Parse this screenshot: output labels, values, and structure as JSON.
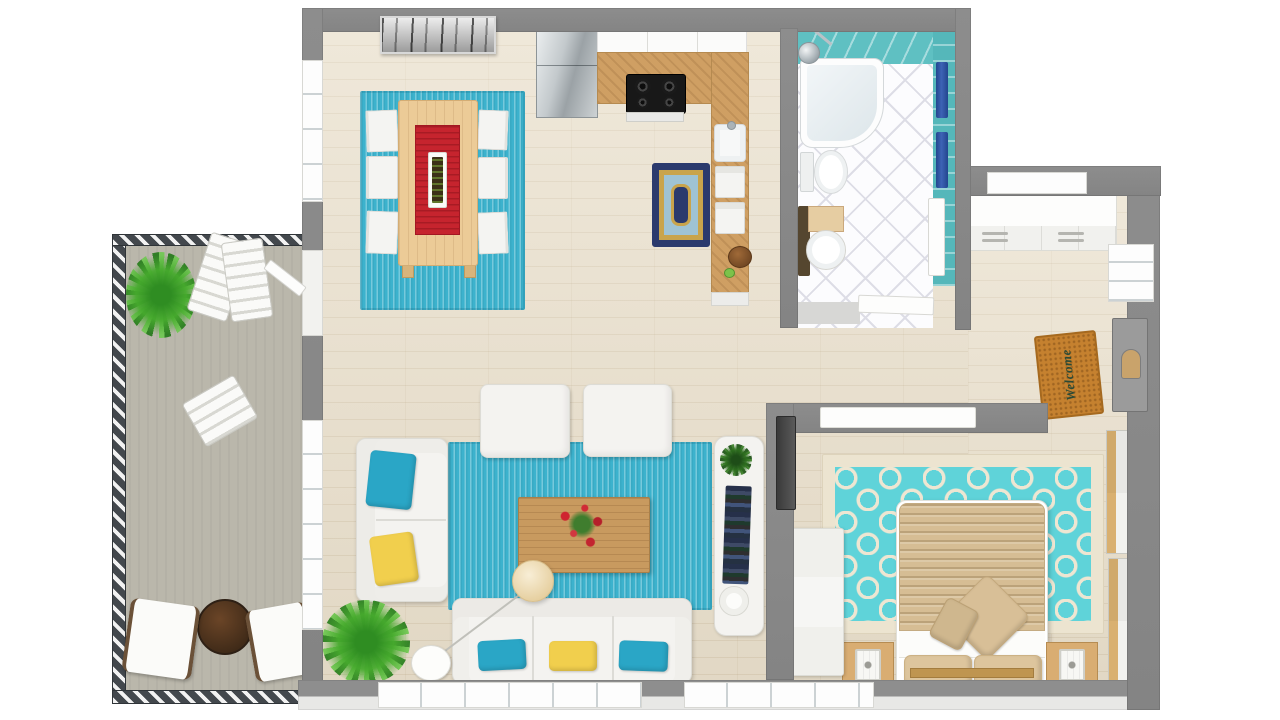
{
  "scene": {
    "type": "3D floor plan render",
    "description": "Top-down 3D floor plan of a one-bedroom apartment with balcony, turquoise accent decor",
    "welcome_mat_text": "Welcome"
  },
  "palette": {
    "wall_gray": "#8d8d8d",
    "wood_floor": "#e9dfcb",
    "balcony_floor": "#bab7ab",
    "rug_teal": "#3cb2cd",
    "bath_tile_teal": "#5fc0c2",
    "bedroom_rug_teal": "#5fd3d9",
    "bedroom_rug_cream": "#ece4d0",
    "runner_red": "#c6242e",
    "accent_yellow": "#f1cf4d",
    "towel_navy": "#3d63b5",
    "counter_wood": "#cf9f63",
    "table_wood": "#eccb97",
    "bed_tan": "#d6bd94",
    "mat_orange": "#c5812f",
    "plant_green": "#4aa832",
    "furniture_white": "#f4f3f0"
  },
  "rooms": [
    {
      "name": "balcony"
    },
    {
      "name": "dining-area"
    },
    {
      "name": "kitchen"
    },
    {
      "name": "bathroom"
    },
    {
      "name": "entry"
    },
    {
      "name": "hallway"
    },
    {
      "name": "living-room"
    },
    {
      "name": "bedroom"
    }
  ],
  "furniture": [
    "dining table with red runner",
    "six dining chairs",
    "dining rug",
    "wall art",
    "refrigerator",
    "L-shaped counter with cooktop and sink",
    "kitchen rug",
    "fruit bowl",
    "bathtub with shower",
    "toilet",
    "vanity sink",
    "two navy towels",
    "entry closet",
    "front door",
    "welcome mat",
    "loveseat",
    "two ottomans",
    "three-seat sofa",
    "coffee table with red flowers",
    "floor lamp",
    "living rug",
    "indoor plants",
    "media console",
    "wall tv",
    "dresser",
    "double bed",
    "two nightstands with lantern lamps",
    "two wardrobes",
    "quatrefoil bedroom rug",
    "patio table",
    "two patio chairs",
    "folded deck chairs",
    "balcony palm",
    "balcony railing"
  ]
}
